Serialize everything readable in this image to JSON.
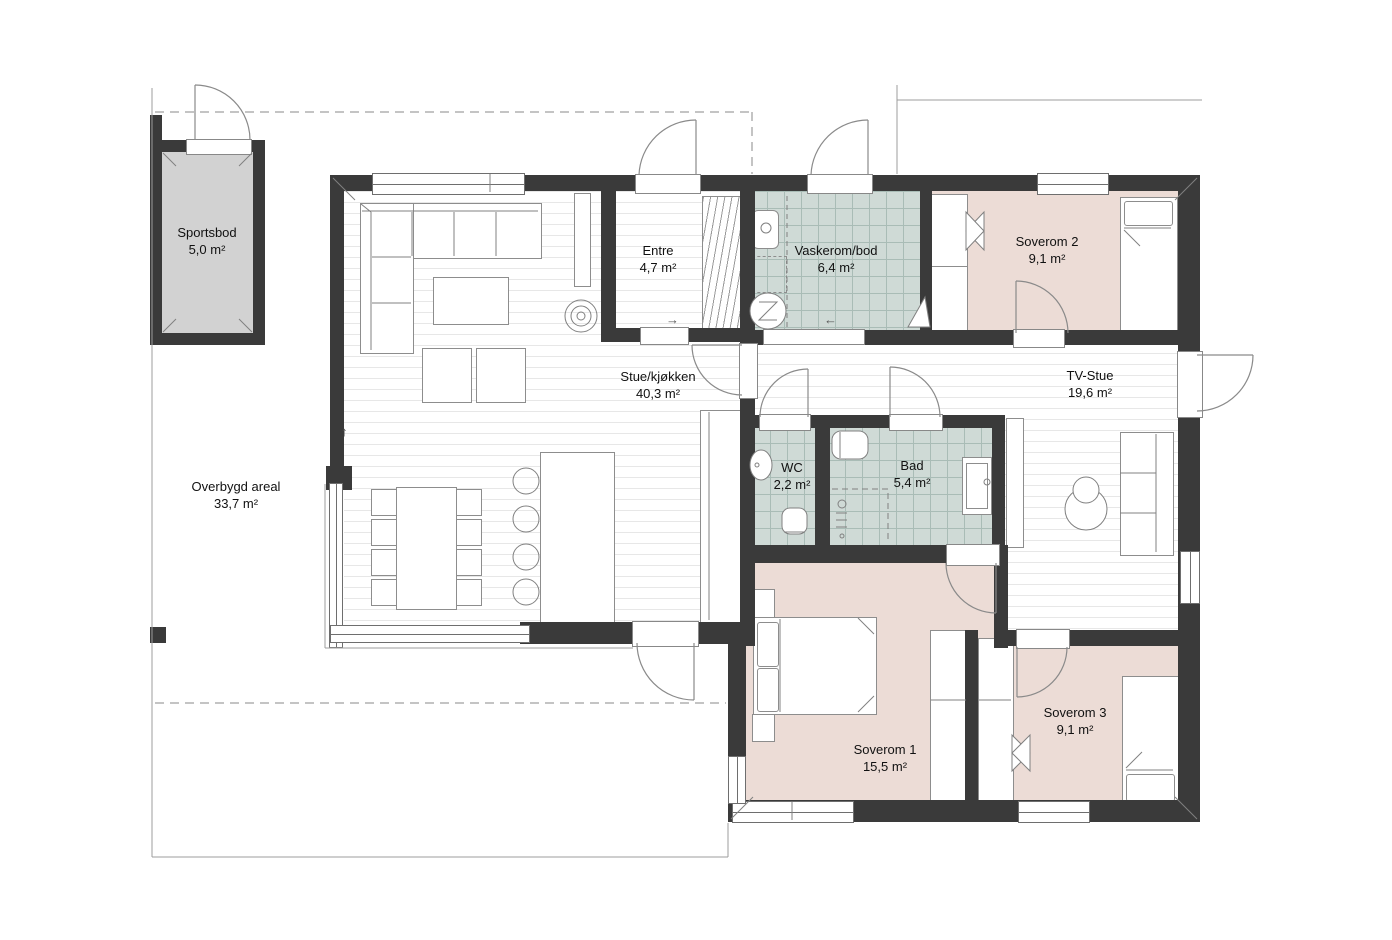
{
  "plan": {
    "rooms": [
      {
        "id": "sportsbod",
        "name": "Sportsbod",
        "area": "5,0 m²"
      },
      {
        "id": "entre",
        "name": "Entre",
        "area": "4,7 m²"
      },
      {
        "id": "vaskerom",
        "name": "Vaskerom/bod",
        "area": "6,4 m²"
      },
      {
        "id": "soverom2",
        "name": "Soverom 2",
        "area": "9,1 m²"
      },
      {
        "id": "stue",
        "name": "Stue/kjøkken",
        "area": "40,3 m²"
      },
      {
        "id": "tvstue",
        "name": "TV-Stue",
        "area": "19,6 m²"
      },
      {
        "id": "wc",
        "name": "WC",
        "area": "2,2 m²"
      },
      {
        "id": "bad",
        "name": "Bad",
        "area": "5,4 m²"
      },
      {
        "id": "soverom1",
        "name": "Soverom 1",
        "area": "15,5 m²"
      },
      {
        "id": "soverom3",
        "name": "Soverom 3",
        "area": "9,1 m²"
      },
      {
        "id": "overbygd",
        "name": "Overbygd areal",
        "area": "33,7 m²"
      }
    ],
    "arrows": {
      "up": "↑",
      "right": "→",
      "left": "←"
    },
    "colors": {
      "wall": "#3a3a3a",
      "bedroom_floor": "#ecdcd6",
      "wet_room_floor": "#cfdad6",
      "storage_floor": "#d2d2d2",
      "background": "#ffffff"
    }
  }
}
